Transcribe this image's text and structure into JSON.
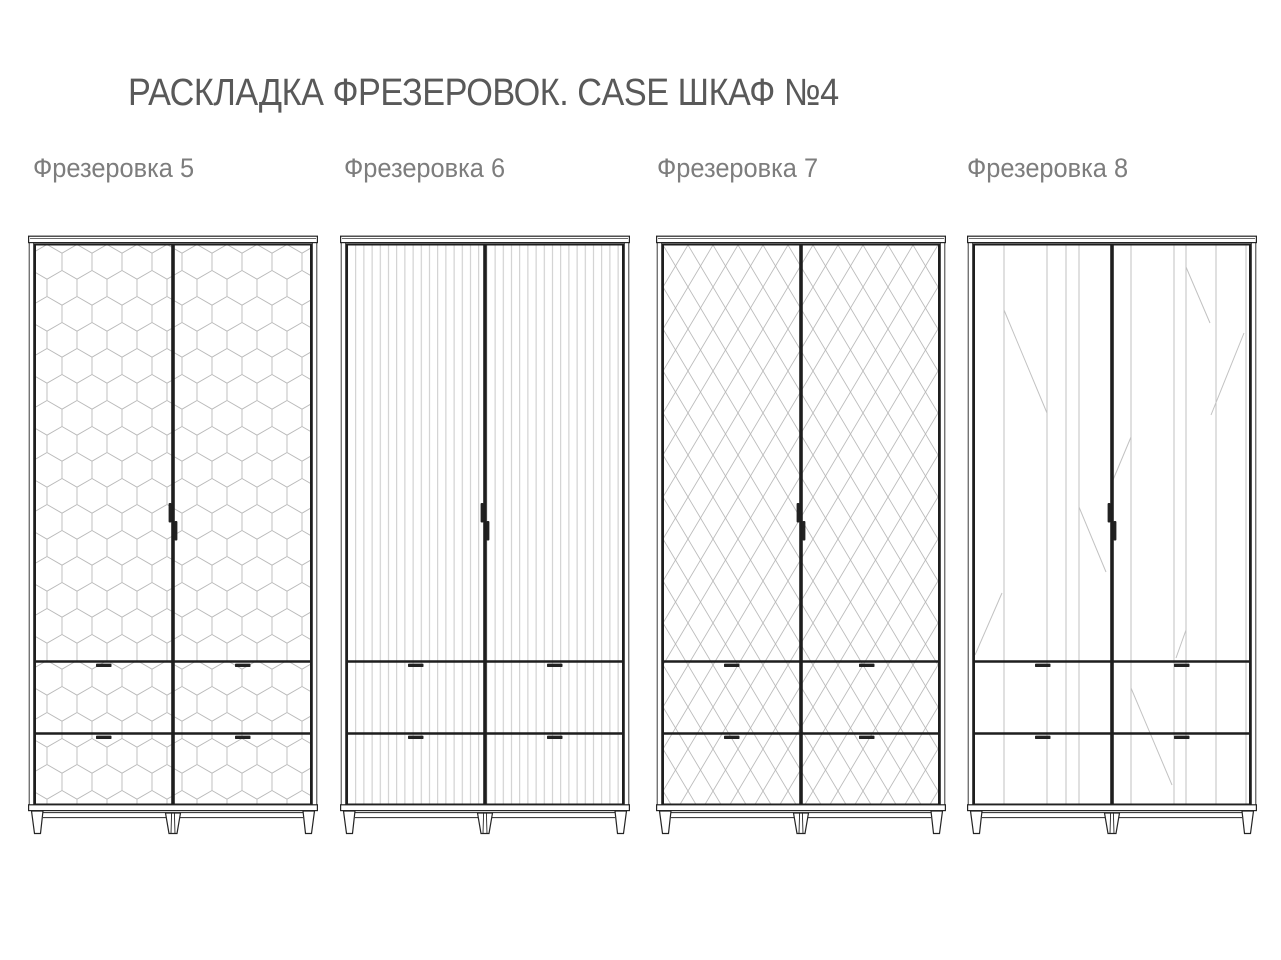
{
  "page": {
    "title": "РАСКЛАДКА ФРЕЗЕРОВОК. CASE ШКАФ №4",
    "background_color": "#ffffff"
  },
  "colors": {
    "outline_dark": "#242424",
    "outline_thin": "#3a3a3a",
    "pattern_hex_line": "#b9b9b9",
    "pattern_stripe_line": "#c9c9c9",
    "pattern_diamond_line": "#bcbcbc",
    "pattern_diagonal_line": "#c2c2c2",
    "handle_fill": "#222222",
    "title_text": "#595959",
    "label_text": "#7d7d7d"
  },
  "wardrobes": [
    {
      "label": "Фрезеровка 5",
      "pattern": "hexagon-honeycomb"
    },
    {
      "label": "Фрезеровка 6",
      "pattern": "vertical-stripes"
    },
    {
      "label": "Фрезеровка 7",
      "pattern": "diamond-lattice"
    },
    {
      "label": "Фрезеровка 8",
      "pattern": "abstract-diagonals"
    }
  ]
}
